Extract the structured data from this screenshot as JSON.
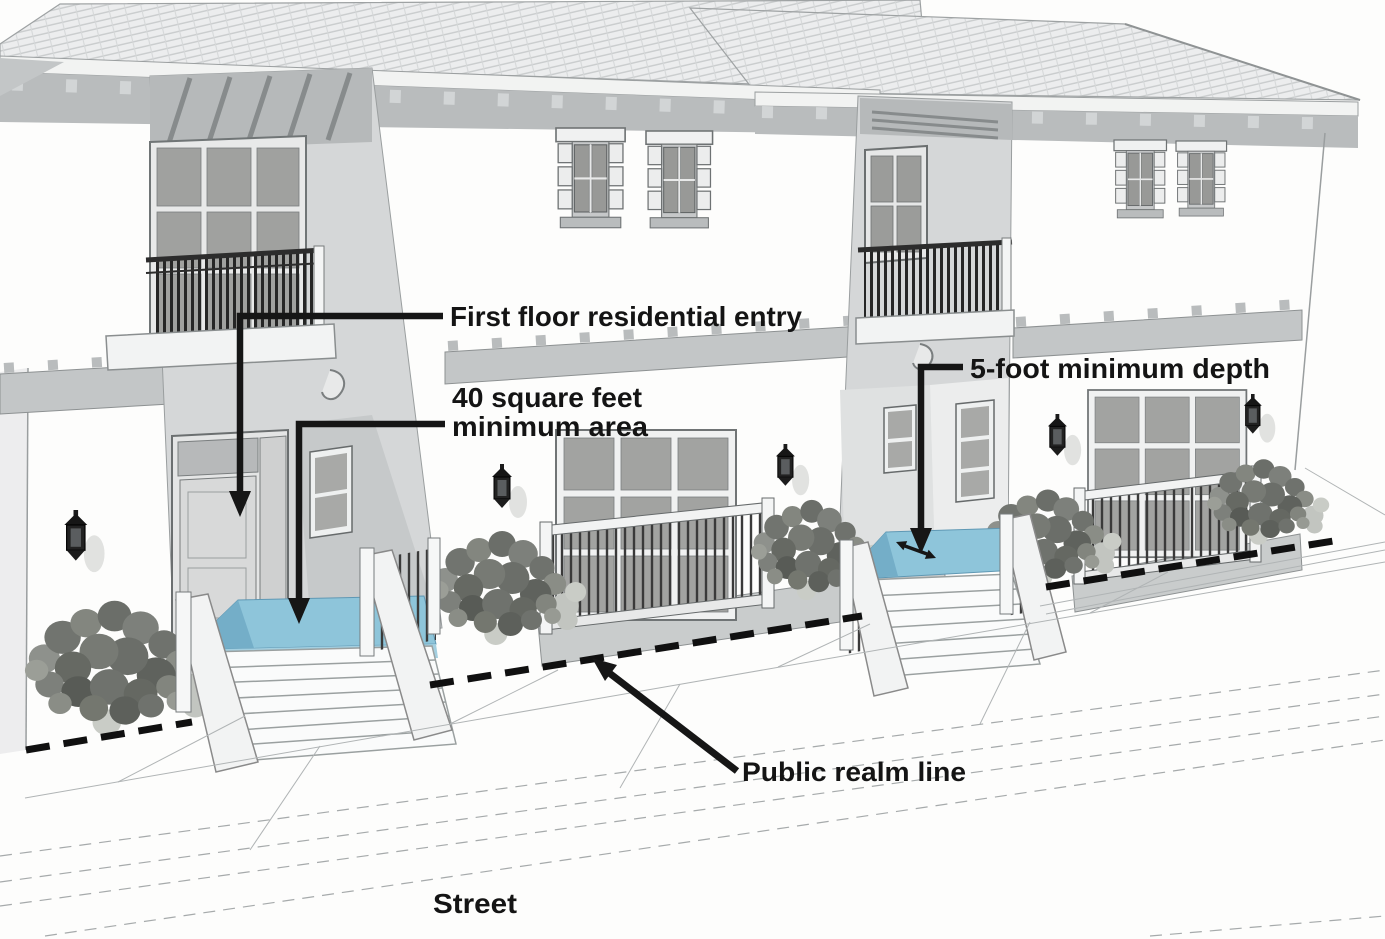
{
  "annotations": {
    "first_floor_entry": "First floor residential entry",
    "min_area_line1": "40 square feet",
    "min_area_line2": "minimum area",
    "min_depth": "5-foot minimum depth",
    "public_realm": "Public realm line",
    "street": "Street"
  },
  "colors": {
    "entry_highlight": "#8ec5da",
    "entry_highlight_shade": "#74aec8",
    "entry_highlight_face": "#a3cfe0",
    "public_realm_line": "#101010",
    "annotation_text": "#141414"
  }
}
